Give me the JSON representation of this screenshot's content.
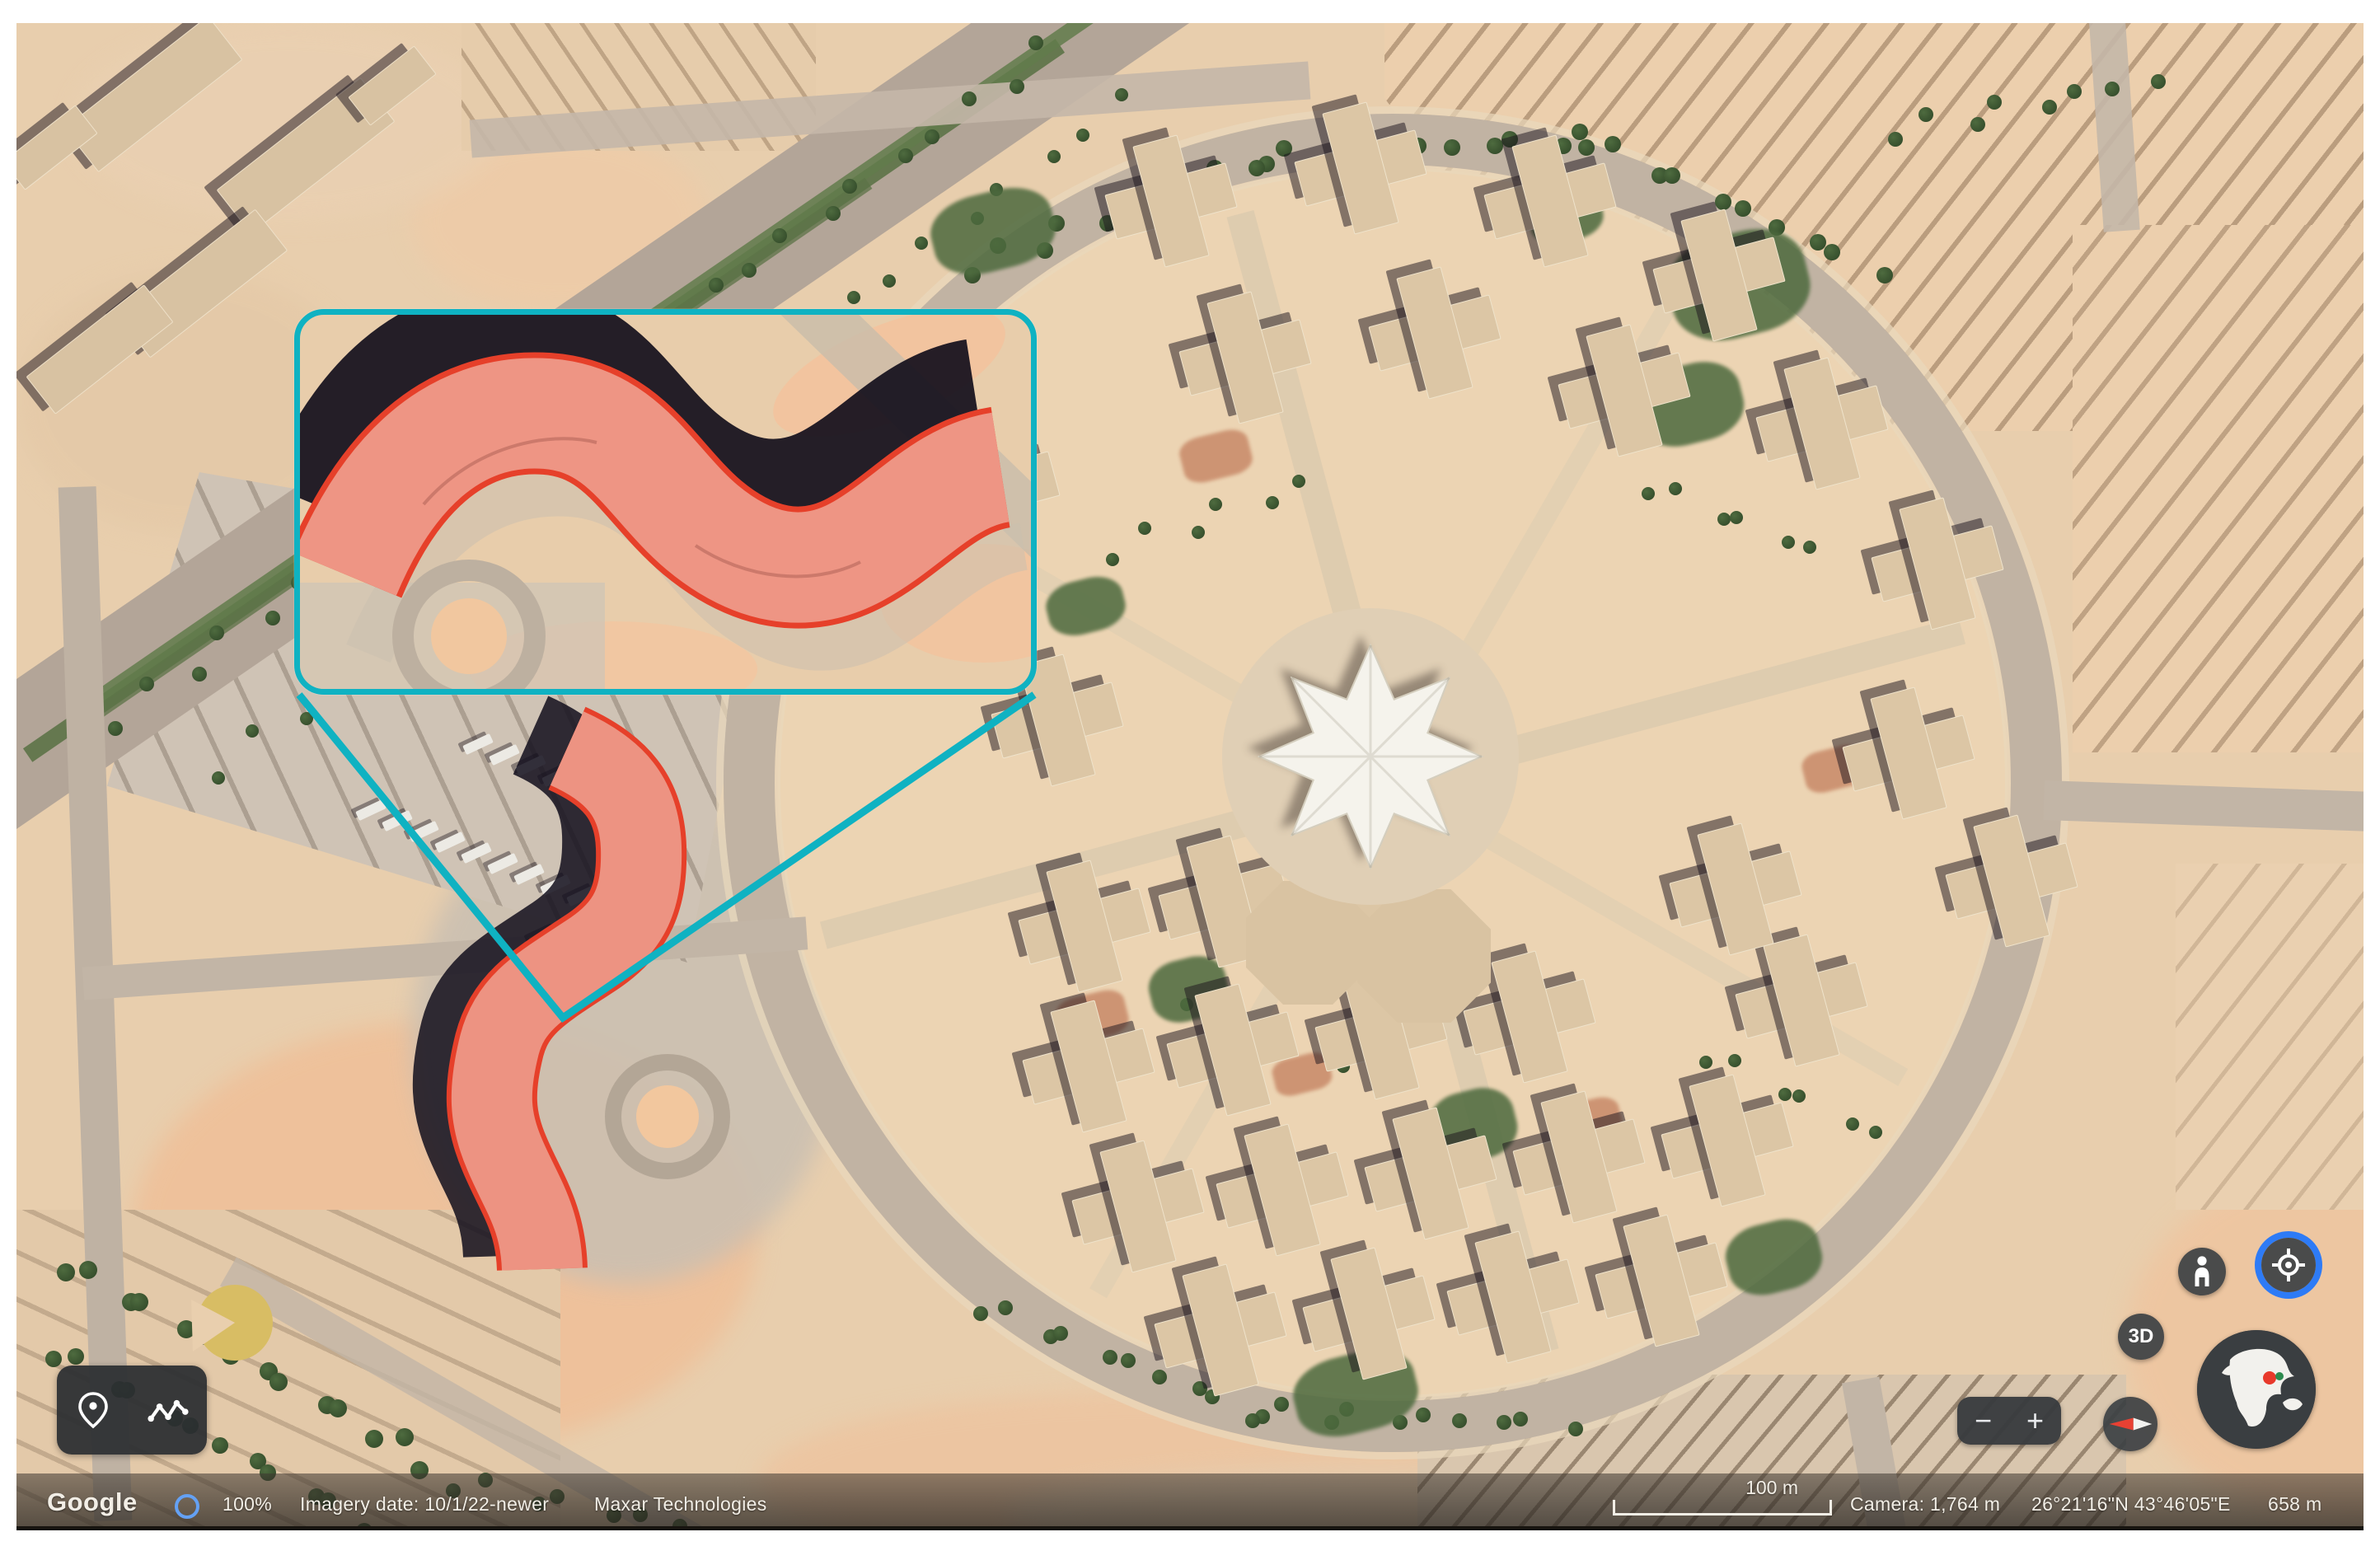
{
  "annotation": {
    "callout_border_color": "#0fb2c2",
    "highlight_outline_color": "#e6402a",
    "highlight_fill_color": "#ee9e8e",
    "callout_description": "zoom-inset-of-s-shaped-building",
    "leader_lines": "teal-triangle-from-callout-to-building"
  },
  "controls": {
    "zoom_out_label": "−",
    "zoom_in_label": "+",
    "threed_label": "3D",
    "pegman_icon": "pegman-street-view",
    "locate_icon": "my-location-target",
    "compass_icon": "compass-needle",
    "globe_icon": "globe-overview-with-location-dot",
    "placemark_icon": "location-pin",
    "measure_icon": "path-measure-polyline"
  },
  "statusbar": {
    "brand": "Google",
    "stream_progress": "100%",
    "imagery_date": "Imagery date: 10/1/22-newer",
    "provider": "Maxar Technologies",
    "scale_label": "100 m",
    "camera_altitude": "Camera: 1,764 m",
    "coordinates": "26°21'16\"N 43°46'05\"E",
    "elevation": "658 m"
  }
}
